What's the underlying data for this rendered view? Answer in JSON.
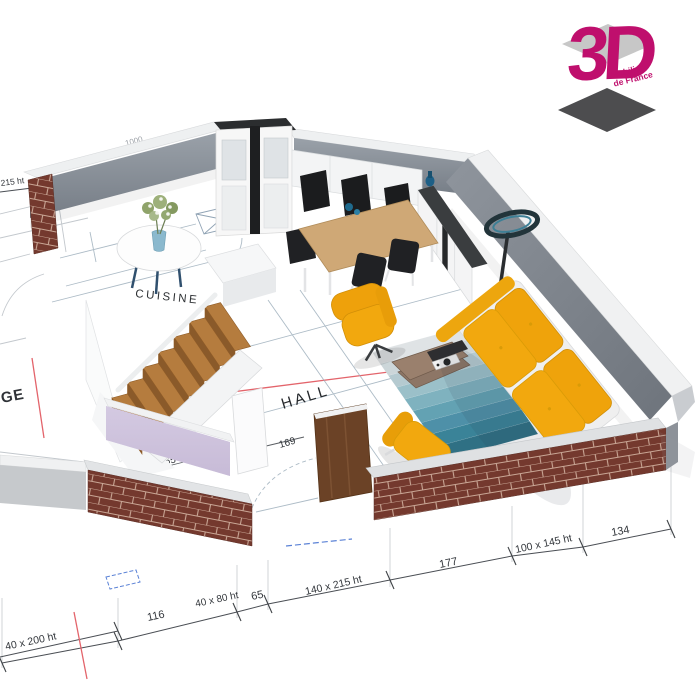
{
  "logo": {
    "brand": "3D",
    "subtitle_line1": "Mobilier",
    "subtitle_line2": "de France"
  },
  "rooms": {
    "cuisine": "CUISINE",
    "hall": "HALL",
    "garage_partial": "GE"
  },
  "dimensions": {
    "back_width": "1000",
    "back_window": "180 x 215 ht",
    "left_window": "215 ht",
    "stair_depth": "337",
    "hall_door": "169",
    "hall_left": "165",
    "front_seg1": "116",
    "front_door": "40 x 80 ht",
    "front_seg2": "65",
    "front_window": "140 x 215 ht",
    "front_seg3": "177",
    "right_window": "100 x 145 ht",
    "right_seg": "134",
    "left_front_window": "40 x 200 ht"
  },
  "colors": {
    "accent": "#BF0F6D",
    "brick": "#74392E",
    "sofa_yellow": "#F2A80E",
    "rug_teal": "#4E90A8",
    "stair_wood": "#B57C3E",
    "wall_gray": "#868D95",
    "lavender": "#CFC4DE",
    "redline": "#E3646B",
    "blueline": "#5B82D6"
  }
}
